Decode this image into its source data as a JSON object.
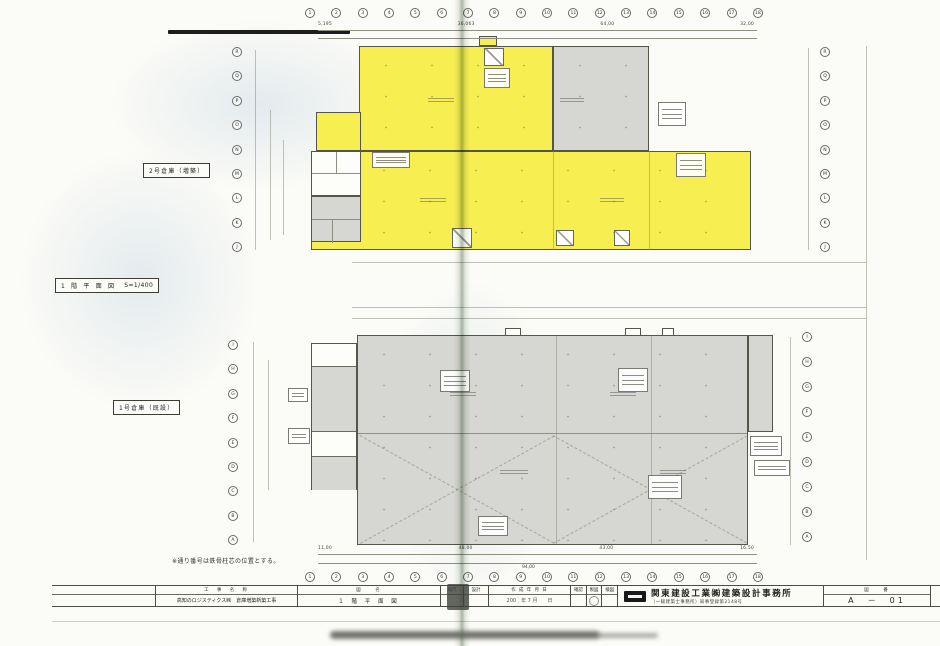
{
  "plan": {
    "upper_building_label": "2号倉庫（増築）",
    "lower_building_label": "1号倉庫（既設）",
    "drawing_title": "1 階 平 面 図",
    "drawing_scale": "S=1/400",
    "footnote": "※通り番号は鉄骨柱芯の位置とする。"
  },
  "grid": {
    "top_numbers": [
      "1",
      "2",
      "3",
      "4",
      "5",
      "6",
      "7",
      "8",
      "9",
      "10",
      "11",
      "12",
      "13",
      "14",
      "15",
      "16",
      "17",
      "18"
    ],
    "bottom_numbers": [
      "1",
      "2",
      "3",
      "4",
      "5",
      "6",
      "7",
      "8",
      "9",
      "10",
      "11",
      "12",
      "13",
      "14",
      "15",
      "16",
      "17",
      "18"
    ],
    "upper_left_letters": [
      "R",
      "Q",
      "P",
      "O",
      "N",
      "M",
      "L",
      "K",
      "J"
    ],
    "upper_right_letters": [
      "R",
      "Q",
      "P",
      "O",
      "N",
      "M",
      "L",
      "K",
      "J"
    ],
    "lower_left_letters": [
      "I",
      "H",
      "G",
      "F",
      "E",
      "D",
      "C",
      "B",
      "A"
    ],
    "lower_right_letters": [
      "I",
      "H",
      "G",
      "F",
      "E",
      "D",
      "C",
      "B",
      "A"
    ]
  },
  "dimensions": {
    "upper_top": [
      "5,195",
      "36,063",
      "64,00",
      "32,00"
    ],
    "lower_bottom": [
      "11,00",
      "48,00",
      "43,00",
      "16,50"
    ],
    "lower_total": "94,00"
  },
  "title_block": {
    "project_label": "工　事　名　称",
    "project_value": "高知のロジスティクス㈱　倉庫増築新築工事",
    "drawing_label": "図　　名",
    "drawing_value": "１ 階 平 面 図",
    "scale_label": "縮尺",
    "designer_label": "設計",
    "date_label": "作 成 年 月 日",
    "date_value": "200　年 7 月　　日",
    "approval_labels": [
      "確認",
      "製図",
      "検図"
    ],
    "company_name": "関東建設工業㈱建築設計事務所",
    "company_sub": "（一級建築士事務所）知事登録第2148号",
    "sheet_label": "図　　番",
    "sheet_value": "A　－　01"
  }
}
